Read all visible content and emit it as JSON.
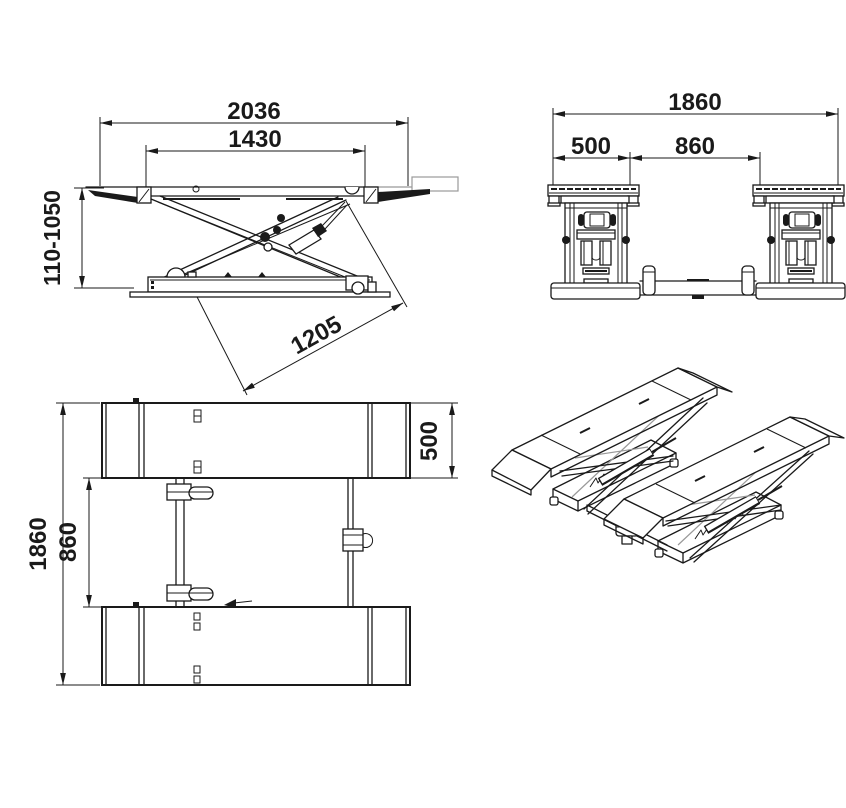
{
  "page": {
    "background": "#ffffff",
    "line_color": "#1a1a1a",
    "accent_gray": "#999999"
  },
  "views": {
    "side": {
      "dim_overall_length": "2036",
      "dim_platform_length": "1430",
      "dim_height_range": "110-1050",
      "dim_base_length": "1205"
    },
    "front": {
      "dim_overall_width": "1860",
      "dim_platform_width": "500",
      "dim_inner_width": "860"
    },
    "top": {
      "dim_overall_length": "1860",
      "dim_inner_spacing": "860",
      "dim_platform_width": "500"
    }
  }
}
